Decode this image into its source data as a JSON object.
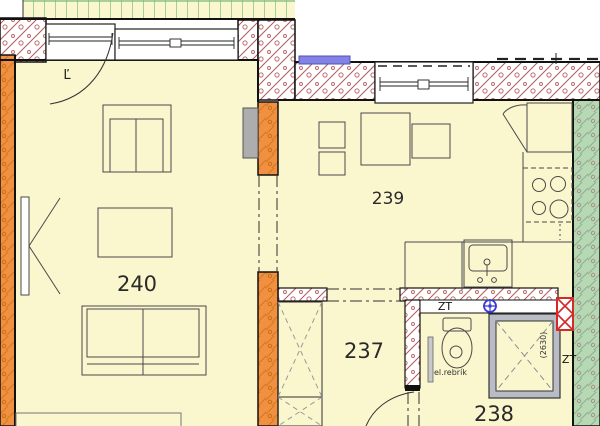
{
  "plan": {
    "type": "apartment-floor-plan",
    "rooms": {
      "living": {
        "number": "240"
      },
      "kitchen": {
        "number": "239"
      },
      "hall": {
        "number": "237"
      },
      "bath": {
        "number": "238"
      }
    },
    "labels": {
      "balcony_door": "Ľ",
      "zt_wc": "ZT",
      "zt_shaft": "ZT",
      "electric_ladder": "el.rebrík",
      "shaft_dimension": "(2630)"
    },
    "colors": {
      "room_fill": "#FAF6CD",
      "wall_orange": "#F09040",
      "wall_hatch_red": "#B06060",
      "wall_green": "#B6D8B3",
      "terrace_grid_green": "#7CB87C",
      "window_blue_lintel": "#8383E6",
      "marker_blue": "#3A3AD4",
      "marker_red": "#D42A2A"
    }
  }
}
